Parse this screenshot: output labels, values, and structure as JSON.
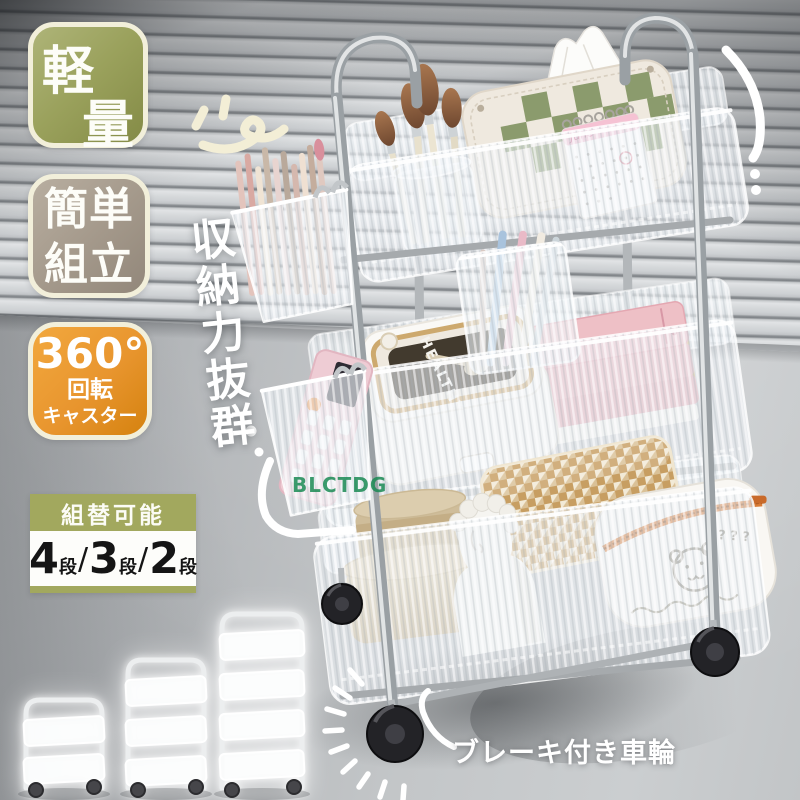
{
  "colors": {
    "badge_olive": "#9aa15c",
    "badge_taupe": "#a59a8c",
    "badge_orange": "#e8952e",
    "badge_border_cream": "#f2efda",
    "reconfig_olive": "#a2a85e",
    "watermark_green": "#1a8a54",
    "wheel_black": "#232327",
    "slogan_white": "#ffffff"
  },
  "badges": {
    "lightweight": {
      "char_top": "軽",
      "char_bottom": "量"
    },
    "easy_assembly": {
      "line1": "簡単",
      "line2": "組立"
    },
    "caster": {
      "degree": "360°",
      "rotation": "回転",
      "caster": "キャスター"
    }
  },
  "vertical_slogan": "収納力抜群",
  "reconfig": {
    "header": "組替可能",
    "separator": "/",
    "options": [
      {
        "num": "4",
        "unit": "段"
      },
      {
        "num": "3",
        "unit": "段"
      },
      {
        "num": "2",
        "unit": "段"
      }
    ]
  },
  "brake_label": "ブレーキ付き車輪",
  "watermark": "BLCTDG",
  "cart_details": {
    "lunchbox_label": "HEALTHY",
    "calendar_month": "June",
    "pouch_marks": "? ? ?"
  }
}
